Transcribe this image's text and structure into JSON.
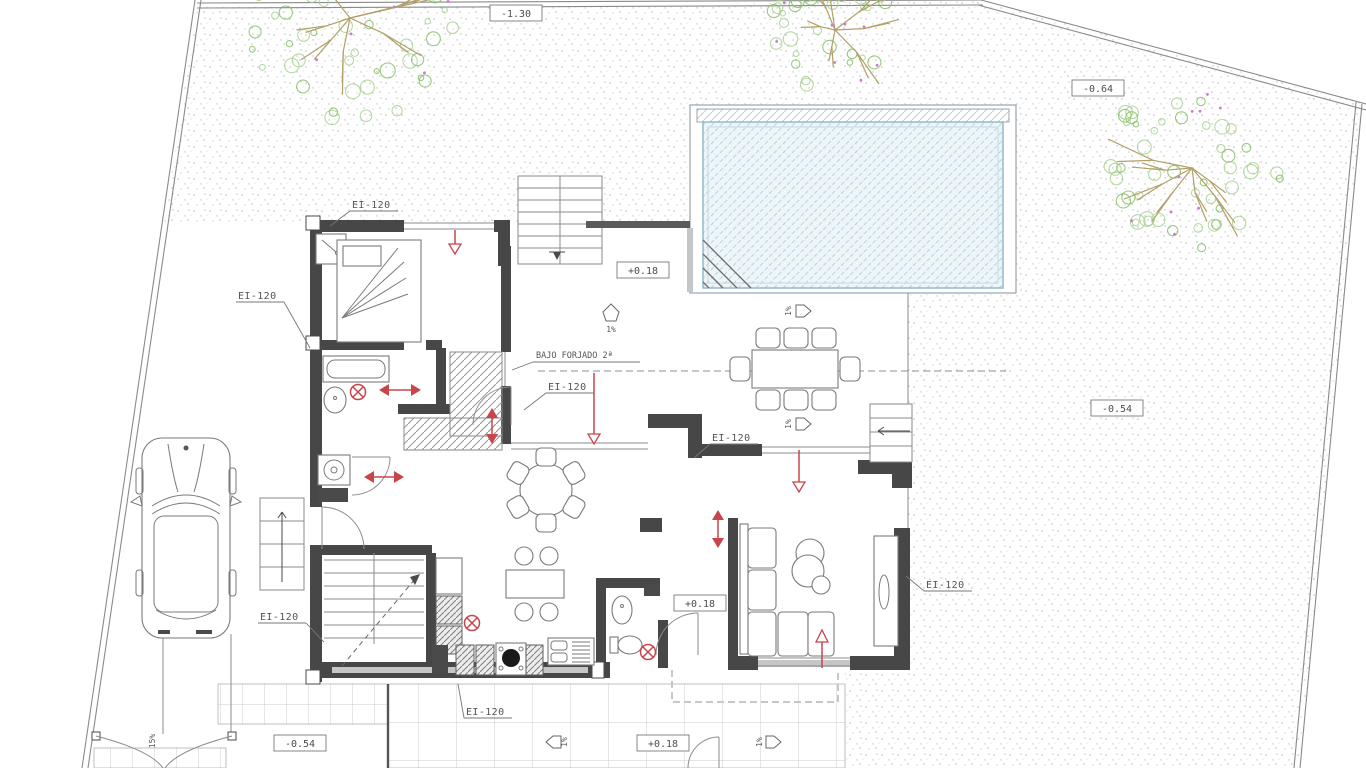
{
  "drawing": {
    "labels": {
      "fire_rating": "EI-120",
      "under_slab": "BAJO FORJADO 2ª",
      "slope": "1%",
      "ramp_slope": "15%"
    },
    "elevations": {
      "garden_top": "-1.30",
      "garden_upper_right": "-0.64",
      "garden_right": "-0.54",
      "terrace_lower_left": "-0.54",
      "terrace_upper": "+0.18",
      "hall_bottom": "+0.18",
      "terrace_bottom": "+0.18"
    },
    "colors": {
      "wall": "#474747",
      "red_marker": "#c8454b",
      "pool_water": "#edf5f9",
      "pool_hatch": "#b8d2e0",
      "tree_foliage": "#7fbb5e",
      "tree_foliage_alt": "#a5cf8d",
      "tree_branch": "#b2a06a",
      "tree_accent": "#c77bd0",
      "stipple": "#bdbdbd",
      "tile_line": "#cccccc"
    }
  }
}
